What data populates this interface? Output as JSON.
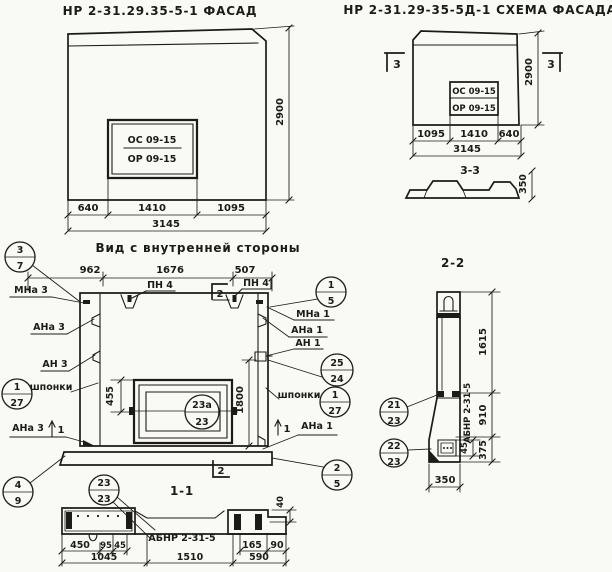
{
  "colors": {
    "ink": "#1d1b17",
    "paper": "#f9f9f5"
  },
  "titles": {
    "facade": "НР 2-31.29.35-5-1 ФАСАД",
    "scheme": "НР 2-31.29-35-5Д-1 СХЕМА ФАСАДА",
    "inner": "Вид с внутренней стороны",
    "s11": "1-1",
    "s22": "2-2",
    "s33": "3-3"
  },
  "facade": {
    "win_top": "ОС 09-15",
    "win_bot": "ОР 09-15",
    "d1": "640",
    "d2": "1410",
    "d3": "1095",
    "total": "3145",
    "height": "2900"
  },
  "scheme": {
    "win_top": "ОС 09-15",
    "win_bot": "ОР 09-15",
    "d1": "1095",
    "d2": "1410",
    "d3": "640",
    "total": "3145",
    "height": "2900",
    "marker": "3",
    "profile_height": "350"
  },
  "inner": {
    "dt1": "962",
    "dt2": "1676",
    "dt3": "507",
    "pn_left": "ПН 4",
    "pn_right": "ПН 4",
    "marker_top": "2",
    "marker_bottom": "2",
    "marker_left": "1",
    "marker_right": "1",
    "win_offset": "455",
    "opening_height": "1800",
    "lbl_mna3": "МНа 3",
    "lbl_ana3": "АНа 3",
    "lbl_an3": "АН 3",
    "lbl_shponki_left": "шпонки",
    "lbl_ana3_b": "АНа 3",
    "lbl_mna1": "МНа 1",
    "lbl_ana1": "АНа 1",
    "lbl_an1": "АН 1",
    "lbl_shponki_right": "шпонки",
    "lbl_ana1_b": "АНа 1",
    "c37": {
      "t": "3",
      "b": "7"
    },
    "c127l": {
      "t": "1",
      "b": "27"
    },
    "c49": {
      "t": "4",
      "b": "9"
    },
    "c15": {
      "t": "1",
      "b": "5"
    },
    "c2524": {
      "t": "25",
      "b": "24"
    },
    "c127r": {
      "t": "1",
      "b": "27"
    },
    "c25": {
      "t": "2",
      "b": "5"
    },
    "c23a": {
      "t": "23а",
      "b": "23"
    }
  },
  "s22": {
    "d1615": "1615",
    "d910": "910",
    "d375": "375",
    "d45": "45",
    "d350": "350",
    "label": "АБНР 2-31-5",
    "c21": {
      "t": "21",
      "b": "23"
    },
    "c22": {
      "t": "22",
      "b": "23"
    }
  },
  "s11": {
    "label": "АБНР 2-31-5",
    "c23": {
      "t": "23",
      "b": "23"
    },
    "d450": "450",
    "d95": "95",
    "d45": "45",
    "d1045": "1045",
    "d1510": "1510",
    "d165": "165",
    "d90": "90",
    "d590": "590",
    "d40": "40"
  }
}
